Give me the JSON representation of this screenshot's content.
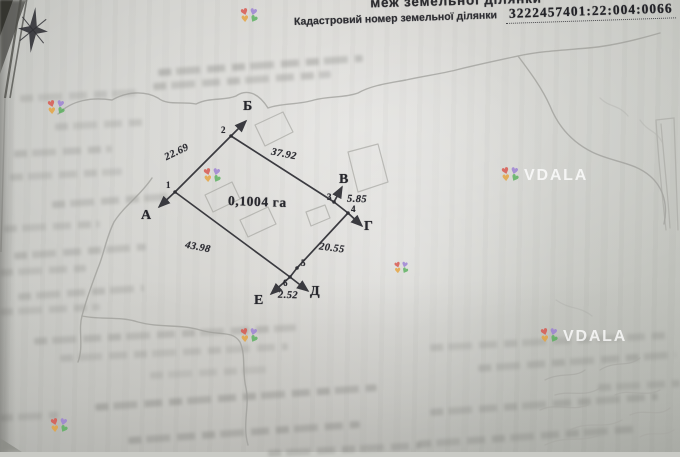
{
  "document": {
    "title_fragment": "меж земельної ділянки",
    "cadastral_label": "Кадастровий номер земельної ділянки",
    "cadastral_number": "3222457401:22:004:0066"
  },
  "plan": {
    "area_label": "0,1004 га",
    "vertices": [
      "1",
      "2",
      "3",
      "4",
      "5",
      "6"
    ],
    "neighbors": [
      "А",
      "Б",
      "В",
      "Г",
      "Д",
      "Е"
    ],
    "edge_lengths": [
      "22.69",
      "37.92",
      "5.85",
      "20.55",
      "2.52",
      "43.98"
    ]
  },
  "watermark": {
    "brand": "VDALA"
  }
}
